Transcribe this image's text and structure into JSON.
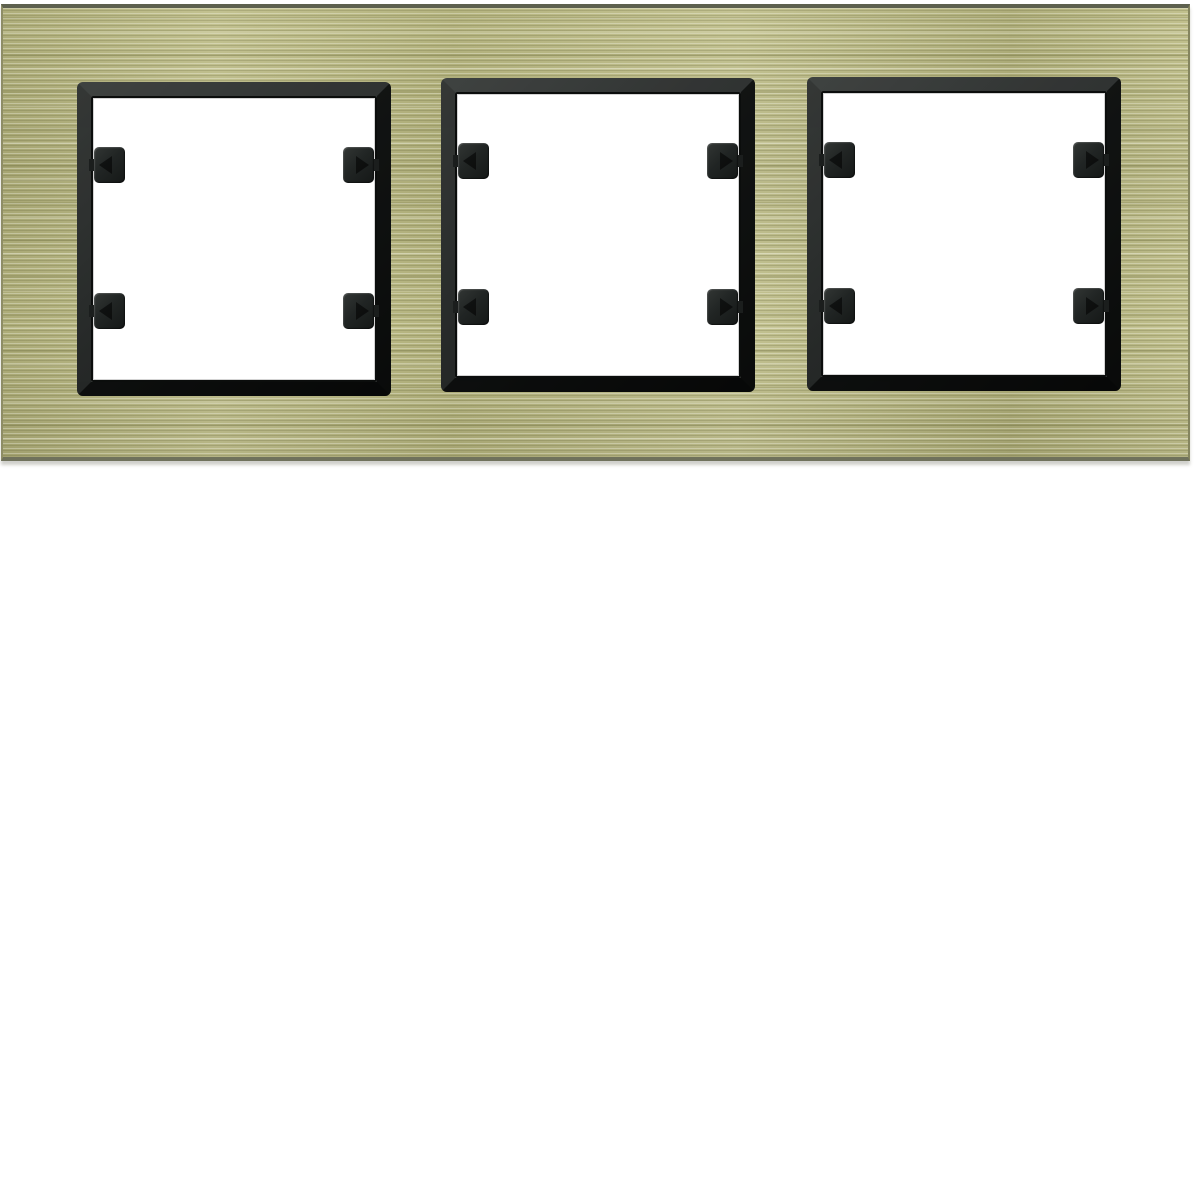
{
  "page": {
    "background": "#ffffff"
  },
  "product": {
    "name": "3-gang horizontal switch cover frame",
    "finish": "brushed brass, black inner frames",
    "gangs": 3,
    "clips_per_window": 4,
    "colors": {
      "backdrop": "#ffffff",
      "plate_base": "#b6b57f",
      "plate_highlight": "#cfce9a",
      "plate_shadow": "#8d8d62",
      "plate_edge": "#5d604e",
      "window_frame": "#1b1e1d",
      "window_frame_dark": "#0e100f",
      "opening": "#ffffff",
      "clip": "#212524"
    },
    "windows": [
      {
        "id": "left"
      },
      {
        "id": "center"
      },
      {
        "id": "right"
      }
    ]
  }
}
